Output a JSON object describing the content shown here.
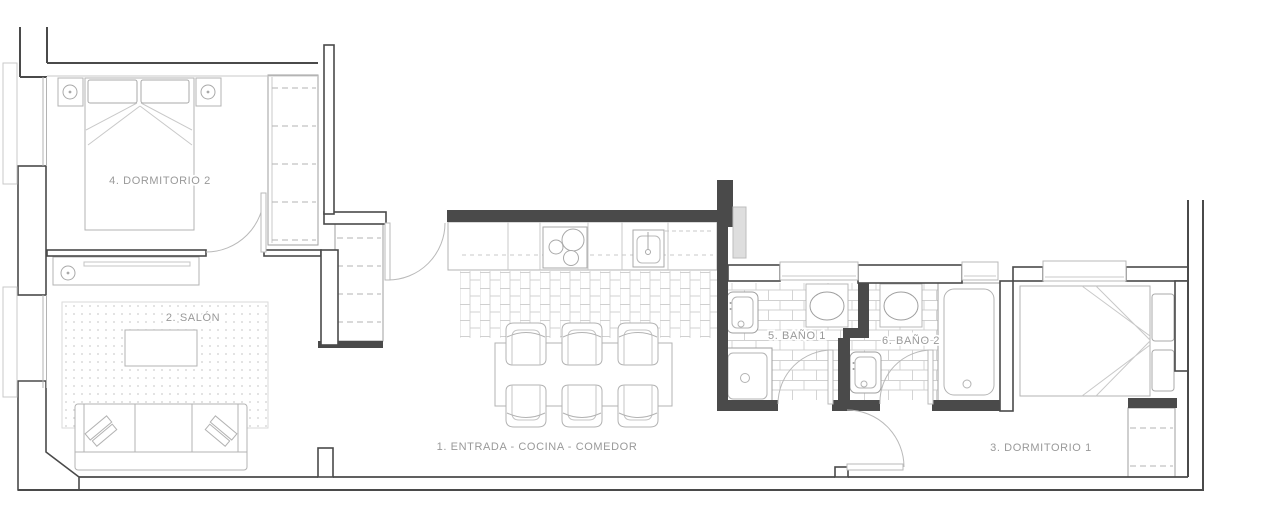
{
  "plan": {
    "type": "apartment-floor-plan",
    "language": "es",
    "rooms": [
      {
        "num": "1",
        "key": "entrada-cocina-comedor",
        "label": "1. ENTRADA - COCINA - COMEDOR"
      },
      {
        "num": "2",
        "key": "salon",
        "label": "2. SALÓN"
      },
      {
        "num": "3",
        "key": "dormitorio-1",
        "label": "3. DORMITORIO 1"
      },
      {
        "num": "4",
        "key": "dormitorio-2",
        "label": "4. DORMITORIO 2"
      },
      {
        "num": "5",
        "key": "bano-1",
        "label": "5. BAÑO 1"
      },
      {
        "num": "6",
        "key": "bano-2",
        "label": "6. BAÑO 2"
      }
    ],
    "furniture": {
      "dormitorio-2": [
        "double-bed",
        "nightstand-with-lamp-left",
        "nightstand-with-lamp-right",
        "wardrobe"
      ],
      "salon": [
        "tv-console",
        "rug",
        "coffee-table",
        "sofa"
      ],
      "entrada-cocina-comedor": [
        "kitchen-counter",
        "cooktop",
        "kitchen-sink",
        "dining-table",
        "hall-closet"
      ],
      "bano-1": [
        "toilet",
        "washbasin",
        "shower"
      ],
      "bano-2": [
        "toilet",
        "washbasin",
        "bathtub"
      ],
      "dormitorio-1": [
        "single-bed",
        "wardrobe"
      ]
    },
    "dining_chairs": 6,
    "doors": 5,
    "windows": 5
  },
  "palette": {
    "wall": "#4a4a4a",
    "furniture_line": "#b3b3b3",
    "fixture_line": "#9f9f9f",
    "light_line": "#c9c9c9",
    "tile_line": "#d0d0d0",
    "label_text": "#999999",
    "background": "#ffffff"
  }
}
